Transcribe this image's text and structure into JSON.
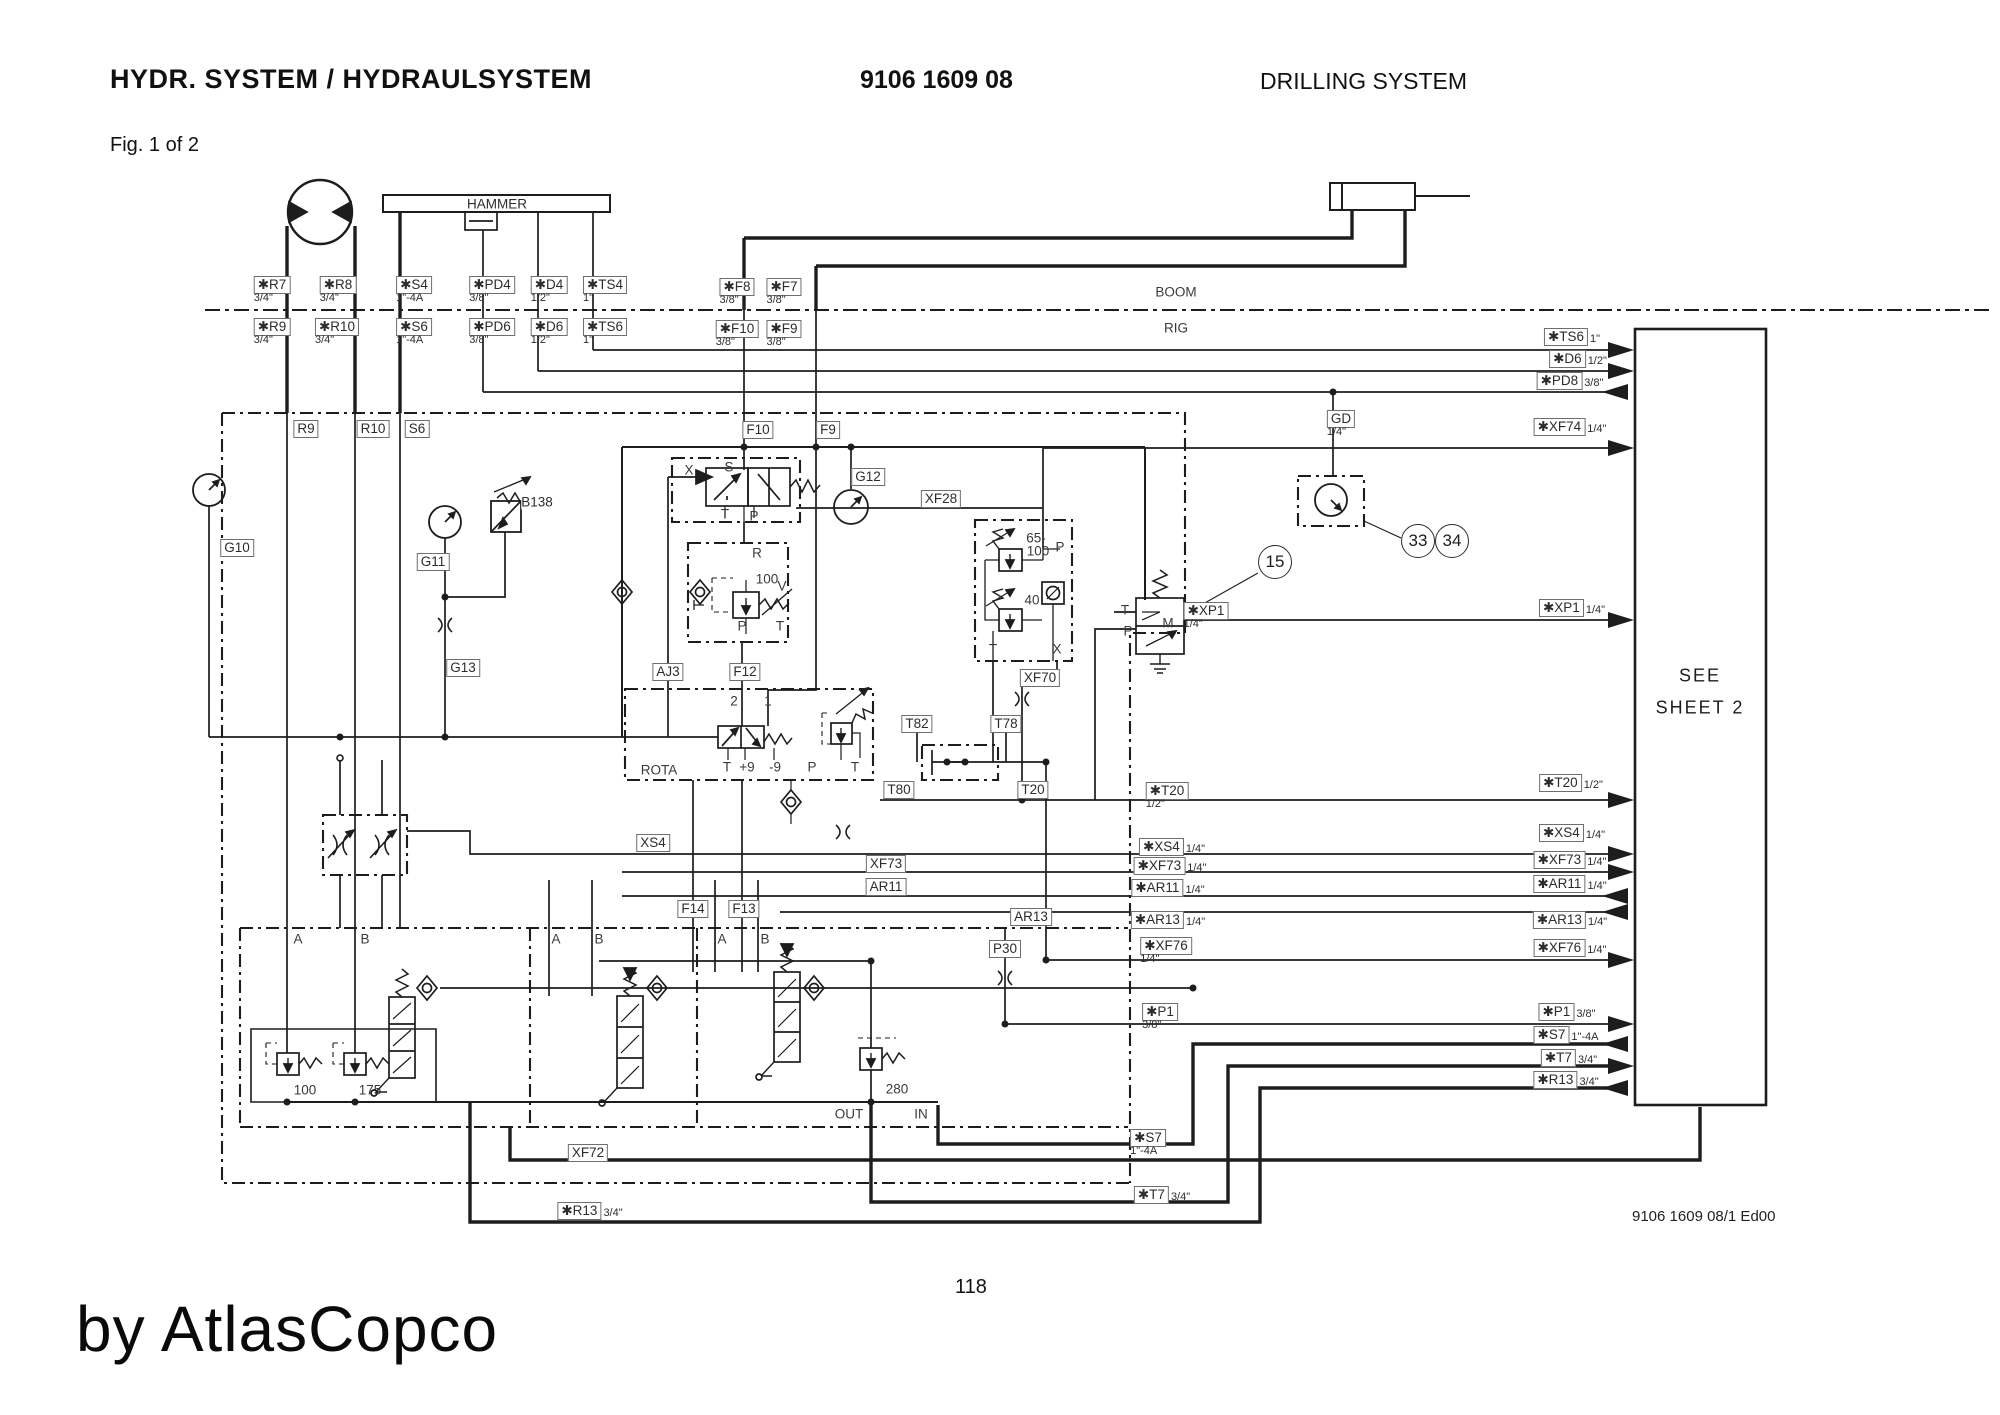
{
  "header": {
    "title": "HYDR. SYSTEM / HYDRAULSYSTEM",
    "doc_number": "9106 1609 08",
    "system": "DRILLING SYSTEM",
    "figure": "Fig. 1 of 2"
  },
  "footer": {
    "page": "118",
    "watermark": "by AtlasCopco",
    "edition": "9106 1609 08/1 Ed00"
  },
  "regions": {
    "hammer": "HAMMER",
    "see_line1": "SEE",
    "see_line2": "SHEET 2"
  },
  "diagram": {
    "labels": [
      {
        "t": "✱R7",
        "s": "3/4\"",
        "x": 272,
        "y": 285,
        "bx": 1,
        "sp": "b"
      },
      {
        "t": "✱R8",
        "s": "3/4\"",
        "x": 338,
        "y": 285,
        "bx": 1,
        "sp": "b"
      },
      {
        "t": "✱S4",
        "s": "1\"-4A",
        "x": 414,
        "y": 285,
        "bx": 1,
        "sp": "b"
      },
      {
        "t": "✱PD4",
        "s": "3/8\"",
        "x": 492,
        "y": 285,
        "bx": 1,
        "sp": "b"
      },
      {
        "t": "✱D4",
        "s": "1/2\"",
        "x": 549,
        "y": 285,
        "bx": 1,
        "sp": "b"
      },
      {
        "t": "✱TS4",
        "s": "1\"",
        "x": 605,
        "y": 285,
        "bx": 1,
        "sp": "b"
      },
      {
        "t": "✱F8",
        "s": "3/8\"",
        "x": 737,
        "y": 287,
        "bx": 1,
        "sp": "b"
      },
      {
        "t": "✱F7",
        "s": "3/8\"",
        "x": 784,
        "y": 287,
        "bx": 1,
        "sp": "b"
      },
      {
        "t": "✱R9",
        "s": "3/4\"",
        "x": 272,
        "y": 327,
        "bx": 1,
        "sp": "b"
      },
      {
        "t": "✱R10",
        "s": "3/4\"",
        "x": 337,
        "y": 327,
        "bx": 1,
        "sp": "b"
      },
      {
        "t": "✱S6",
        "s": "1\"-4A",
        "x": 414,
        "y": 327,
        "bx": 1,
        "sp": "b"
      },
      {
        "t": "✱PD6",
        "s": "3/8\"",
        "x": 492,
        "y": 327,
        "bx": 1,
        "sp": "b"
      },
      {
        "t": "✱D6",
        "s": "1/2\"",
        "x": 549,
        "y": 327,
        "bx": 1,
        "sp": "b"
      },
      {
        "t": "✱TS6",
        "s": "1\"",
        "x": 605,
        "y": 327,
        "bx": 1,
        "sp": "b"
      },
      {
        "t": "✱F10",
        "s": "3/8\"",
        "x": 737,
        "y": 329,
        "bx": 1,
        "sp": "b"
      },
      {
        "t": "✱F9",
        "s": "3/8\"",
        "x": 784,
        "y": 329,
        "bx": 1,
        "sp": "b"
      },
      {
        "t": "✱TS6",
        "s": "1\"",
        "x": 1572,
        "y": 337,
        "bx": 1,
        "sp": "r"
      },
      {
        "t": "✱D6",
        "s": "1/2\"",
        "x": 1578,
        "y": 359,
        "bx": 1,
        "sp": "r"
      },
      {
        "t": "✱PD8",
        "s": "3/8\"",
        "x": 1570,
        "y": 381,
        "bx": 1,
        "sp": "r"
      },
      {
        "t": "✱XF74",
        "s": "1/4\"",
        "x": 1570,
        "y": 427,
        "bx": 1,
        "sp": "r"
      },
      {
        "t": "✱XP1",
        "s": "1/4\"",
        "x": 1572,
        "y": 608,
        "bx": 1,
        "sp": "r"
      },
      {
        "t": "✱T20",
        "s": "1/2\"",
        "x": 1571,
        "y": 783,
        "bx": 1,
        "sp": "r"
      },
      {
        "t": "✱XS4",
        "s": "1/4\"",
        "x": 1572,
        "y": 833,
        "bx": 1,
        "sp": "r"
      },
      {
        "t": "✱XF73",
        "s": "1/4\"",
        "x": 1570,
        "y": 860,
        "bx": 1,
        "sp": "r"
      },
      {
        "t": "✱AR11",
        "s": "1/4\"",
        "x": 1570,
        "y": 884,
        "bx": 1,
        "sp": "r"
      },
      {
        "t": "✱AR13",
        "s": "1/4\"",
        "x": 1570,
        "y": 920,
        "bx": 1,
        "sp": "r"
      },
      {
        "t": "✱XF76",
        "s": "1/4\"",
        "x": 1570,
        "y": 948,
        "bx": 1,
        "sp": "r"
      },
      {
        "t": "✱P1",
        "s": "3/8\"",
        "x": 1567,
        "y": 1012,
        "bx": 1,
        "sp": "r"
      },
      {
        "t": "✱S7",
        "s": "1\"-4A",
        "x": 1566,
        "y": 1035,
        "bx": 1,
        "sp": "r"
      },
      {
        "t": "✱T7",
        "s": "3/4\"",
        "x": 1569,
        "y": 1058,
        "bx": 1,
        "sp": "r"
      },
      {
        "t": "✱R13",
        "s": "3/4\"",
        "x": 1566,
        "y": 1080,
        "bx": 1,
        "sp": "r"
      },
      {
        "t": "✱XP1",
        "s": "1/4\"",
        "x": 1206,
        "y": 611,
        "bx": 1,
        "sp": "b"
      },
      {
        "t": "✱T20",
        "s": "1/2\"",
        "x": 1167,
        "y": 791,
        "bx": 1,
        "sp": "b"
      },
      {
        "t": "✱XS4",
        "s": "1/4\"",
        "x": 1172,
        "y": 847,
        "bx": 1,
        "sp": "r"
      },
      {
        "t": "✱XF73",
        "s": "1/4\"",
        "x": 1170,
        "y": 866,
        "bx": 1,
        "sp": "r"
      },
      {
        "t": "✱AR11",
        "s": "1/4\"",
        "x": 1168,
        "y": 888,
        "bx": 1,
        "sp": "r"
      },
      {
        "t": "✱AR13",
        "s": "1/4\"",
        "x": 1168,
        "y": 920,
        "bx": 1,
        "sp": "r"
      },
      {
        "t": "✱XF76",
        "s": "1/4\"",
        "x": 1166,
        "y": 946,
        "bx": 1,
        "sp": "b"
      },
      {
        "t": "✱P1",
        "s": "3/8\"",
        "x": 1160,
        "y": 1012,
        "bx": 1,
        "sp": "b"
      },
      {
        "t": "✱S7",
        "s": "1\"-4A",
        "x": 1148,
        "y": 1138,
        "bx": 1,
        "sp": "b"
      },
      {
        "t": "✱T7",
        "s": "3/4\"",
        "x": 1162,
        "y": 1195,
        "bx": 1,
        "sp": "r"
      },
      {
        "t": "✱R13",
        "s": "3/4\"",
        "x": 590,
        "y": 1211,
        "bx": 1,
        "sp": "r"
      },
      {
        "t": "GD",
        "s": "1/4\"",
        "x": 1341,
        "y": 419,
        "bx": 1,
        "sp": "b"
      },
      {
        "t": "R9",
        "s": null,
        "x": 306,
        "y": 429,
        "bx": 1,
        "sp": "r"
      },
      {
        "t": "R10",
        "s": null,
        "x": 373,
        "y": 429,
        "bx": 1,
        "sp": "r"
      },
      {
        "t": "S6",
        "s": null,
        "x": 417,
        "y": 429,
        "bx": 1,
        "sp": "r"
      },
      {
        "t": "F10",
        "s": null,
        "x": 758,
        "y": 430,
        "bx": 1,
        "sp": "r"
      },
      {
        "t": "F9",
        "s": null,
        "x": 828,
        "y": 430,
        "bx": 1,
        "sp": "r"
      },
      {
        "t": "G10",
        "s": null,
        "x": 237,
        "y": 548,
        "bx": 1,
        "sp": "r"
      },
      {
        "t": "G11",
        "s": null,
        "x": 433,
        "y": 562,
        "bx": 1,
        "sp": "r"
      },
      {
        "t": "G13",
        "s": null,
        "x": 463,
        "y": 668,
        "bx": 1,
        "sp": "r"
      },
      {
        "t": "G12",
        "s": null,
        "x": 868,
        "y": 477,
        "bx": 1,
        "sp": "r"
      },
      {
        "t": "XF28",
        "s": null,
        "x": 941,
        "y": 499,
        "bx": 1,
        "sp": "r"
      },
      {
        "t": "AJ3",
        "s": null,
        "x": 668,
        "y": 672,
        "bx": 1,
        "sp": "r"
      },
      {
        "t": "F12",
        "s": null,
        "x": 745,
        "y": 672,
        "bx": 1,
        "sp": "r"
      },
      {
        "t": "XS4",
        "s": null,
        "x": 653,
        "y": 843,
        "bx": 1,
        "sp": "r"
      },
      {
        "t": "XF73",
        "s": null,
        "x": 886,
        "y": 864,
        "bx": 1,
        "sp": "r"
      },
      {
        "t": "AR11",
        "s": null,
        "x": 886,
        "y": 887,
        "bx": 1,
        "sp": "r"
      },
      {
        "t": "AR13",
        "s": null,
        "x": 1031,
        "y": 917,
        "bx": 1,
        "sp": "r"
      },
      {
        "t": "F14",
        "s": null,
        "x": 693,
        "y": 909,
        "bx": 1,
        "sp": "r"
      },
      {
        "t": "F13",
        "s": null,
        "x": 744,
        "y": 909,
        "bx": 1,
        "sp": "r"
      },
      {
        "t": "T82",
        "s": null,
        "x": 917,
        "y": 724,
        "bx": 1,
        "sp": "r"
      },
      {
        "t": "T78",
        "s": null,
        "x": 1006,
        "y": 724,
        "bx": 1,
        "sp": "r"
      },
      {
        "t": "T80",
        "s": null,
        "x": 899,
        "y": 790,
        "bx": 1,
        "sp": "r"
      },
      {
        "t": "T20",
        "s": null,
        "x": 1033,
        "y": 790,
        "bx": 1,
        "sp": "r"
      },
      {
        "t": "XF70",
        "s": null,
        "x": 1040,
        "y": 678,
        "bx": 1,
        "sp": "r"
      },
      {
        "t": "P30",
        "s": null,
        "x": 1005,
        "y": 949,
        "bx": 1,
        "sp": "r"
      },
      {
        "t": "XF72",
        "s": null,
        "x": 588,
        "y": 1153,
        "bx": 1,
        "sp": "r"
      },
      {
        "t": "B138",
        "s": null,
        "x": 537,
        "y": 502,
        "bx": 0,
        "sp": "r"
      }
    ],
    "ports": [
      {
        "t": "BOOM",
        "x": 1176,
        "y": 292
      },
      {
        "t": "RIG",
        "x": 1176,
        "y": 328
      },
      {
        "t": "X",
        "x": 689,
        "y": 470
      },
      {
        "t": "S",
        "x": 729,
        "y": 467
      },
      {
        "t": "T",
        "x": 725,
        "y": 514
      },
      {
        "t": "P",
        "x": 754,
        "y": 516
      },
      {
        "t": "R",
        "x": 757,
        "y": 553
      },
      {
        "t": "100",
        "x": 767,
        "y": 579
      },
      {
        "t": "V",
        "x": 782,
        "y": 586
      },
      {
        "t": "P",
        "x": 742,
        "y": 626
      },
      {
        "t": "T",
        "x": 780,
        "y": 626
      },
      {
        "t": "2",
        "x": 734,
        "y": 701
      },
      {
        "t": "1",
        "x": 768,
        "y": 701
      },
      {
        "t": "ROTA",
        "x": 659,
        "y": 770
      },
      {
        "t": "T",
        "x": 727,
        "y": 767
      },
      {
        "t": "+9",
        "x": 747,
        "y": 767
      },
      {
        "t": "-9",
        "x": 775,
        "y": 767
      },
      {
        "t": "P",
        "x": 812,
        "y": 767
      },
      {
        "t": "T",
        "x": 855,
        "y": 767
      },
      {
        "t": "65-",
        "x": 1036,
        "y": 538
      },
      {
        "t": "100",
        "x": 1038,
        "y": 551
      },
      {
        "t": "P",
        "x": 1060,
        "y": 547
      },
      {
        "t": "40",
        "x": 1032,
        "y": 600
      },
      {
        "t": "T",
        "x": 993,
        "y": 649
      },
      {
        "t": "X",
        "x": 1057,
        "y": 649
      },
      {
        "t": "T",
        "x": 1125,
        "y": 610
      },
      {
        "t": "P",
        "x": 1128,
        "y": 631
      },
      {
        "t": "M",
        "x": 1168,
        "y": 623
      },
      {
        "t": "A",
        "x": 298,
        "y": 939
      },
      {
        "t": "B",
        "x": 365,
        "y": 939
      },
      {
        "t": "A",
        "x": 556,
        "y": 939
      },
      {
        "t": "B",
        "x": 599,
        "y": 939
      },
      {
        "t": "A",
        "x": 722,
        "y": 939
      },
      {
        "t": "B",
        "x": 765,
        "y": 939
      },
      {
        "t": "100",
        "x": 305,
        "y": 1090
      },
      {
        "t": "175",
        "x": 370,
        "y": 1090
      },
      {
        "t": "280",
        "x": 897,
        "y": 1089
      },
      {
        "t": "OUT",
        "x": 849,
        "y": 1114
      },
      {
        "t": "IN",
        "x": 921,
        "y": 1114
      }
    ],
    "callouts": [
      {
        "t": "15",
        "x": 1275,
        "y": 562
      },
      {
        "t": "33",
        "x": 1418,
        "y": 541
      },
      {
        "t": "34",
        "x": 1452,
        "y": 541
      }
    ]
  }
}
